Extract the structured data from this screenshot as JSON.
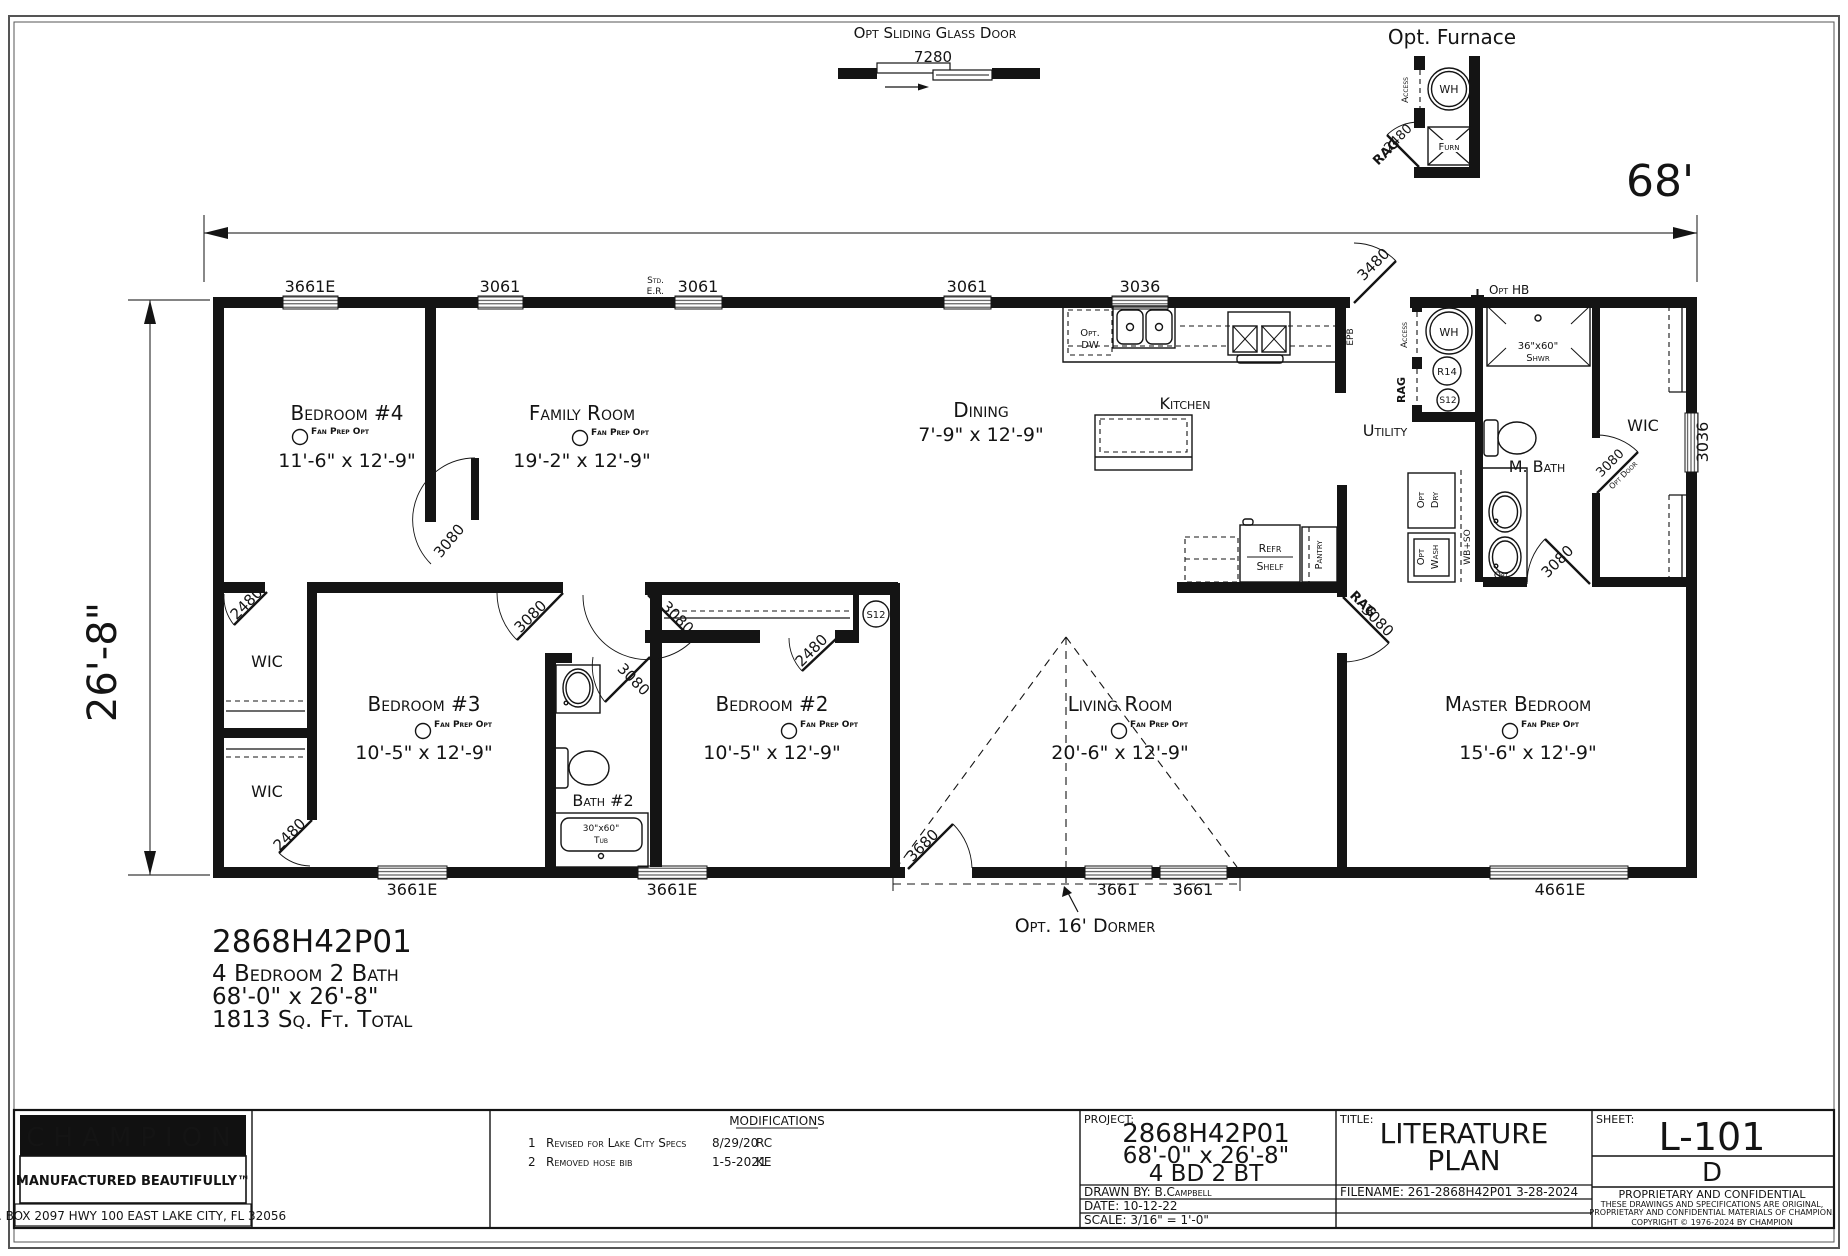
{
  "header": {
    "sliding_door_label": "Opt Sliding Glass Door",
    "sliding_door_dim": "7280",
    "furnace_label": "Opt. Furnace"
  },
  "furnace_detail": {
    "access": "Access",
    "wh": "WH",
    "furn": "Furn",
    "door": "2480",
    "rag": "RAG"
  },
  "dims": {
    "width": "68'",
    "depth": "26'-8\""
  },
  "top_windows": [
    "3661E",
    "3061",
    "3061",
    "3061",
    "3036"
  ],
  "bottom_windows": [
    "3661E",
    "3661E",
    "3661",
    "3661",
    "4661E"
  ],
  "right_window": "3036",
  "top_notes": {
    "std": "Std.",
    "er": "E.R.",
    "opt_hb": "Opt HB",
    "entry_door": "3480"
  },
  "bottom_notes": {
    "entry_door": "3680",
    "dormer": "Opt. 16' Dormer"
  },
  "fan_note": "Fan Prep Opt",
  "rooms": {
    "bedroom4": {
      "name": "Bedroom #4",
      "dims": "11'-6\" x 12'-9\""
    },
    "family": {
      "name": "Family Room",
      "dims": "19'-2\" x 12'-9\""
    },
    "dining": {
      "name": "Dining",
      "dims": "7'-9\" x 12'-9\""
    },
    "kitchen": {
      "name": "Kitchen"
    },
    "utility": {
      "name": "Utility"
    },
    "mbath": {
      "name": "M. Bath"
    },
    "master": {
      "name": "Master Bedroom",
      "dims": "15'-6\" x 12'-9\""
    },
    "living": {
      "name": "Living Room",
      "dims": "20'-6\" x 12'-9\""
    },
    "bedroom3": {
      "name": "Bedroom #3",
      "dims": "10'-5\" x 12'-9\""
    },
    "bedroom2": {
      "name": "Bedroom #2",
      "dims": "10'-5\" x 12'-9\""
    },
    "bath2": {
      "name": "Bath #2"
    },
    "wic_upper": "WIC",
    "wic_lower": "WIC",
    "wic_master": "WIC"
  },
  "doors": {
    "bedroom4": "3080",
    "bedroom3": "3080",
    "bedroom2": "3080",
    "bath2": "3080",
    "wic_upper": "2480",
    "wic_lower": "2480",
    "closet2": "2480",
    "master_rag": "RAG",
    "master_rag_dim": "3080",
    "mbath": "3080",
    "mwic": "3080",
    "mwic_note": "Opt Door"
  },
  "kitchen_detail": {
    "opt_dw1": "Opt.",
    "opt_dw2": "DW",
    "epb": "EPB"
  },
  "utility_detail": {
    "access": "Access",
    "rag": "RAG",
    "wh": "WH",
    "r14": "R14",
    "s12": "S12",
    "opt_dry1": "Opt",
    "opt_dry2": "Dry",
    "opt_wash1": "Opt",
    "opt_wash2": "Wash",
    "wb_so": "WB+SO"
  },
  "closet2_s12": "S12",
  "mbath_detail": {
    "shower_size": "36\"x60\"",
    "shower": "Shwr",
    "sink_opt": "Opt"
  },
  "bath2_detail": {
    "tub_size": "30\"x60\"",
    "tub": "Tub"
  },
  "storage": {
    "refr": "Refr",
    "shelf": "Shelf",
    "pantry": "Pantry"
  },
  "model_info": {
    "model": "2868H42P01",
    "config": "4 Bedroom 2 Bath",
    "size": "68'-0\" x 26'-8\"",
    "area": "1813 Sq. Ft. Total"
  },
  "title_block": {
    "brand": "CHAMPION",
    "tagline": "MANUFACTURED BEAUTIFULLY™",
    "address": "P.O. BOX 2097 HWY 100 EAST LAKE CITY, FL  32056",
    "modifications_title": "MODIFICATIONS",
    "modifications": [
      {
        "num": "1",
        "desc": "Revised for Lake City Specs",
        "date": "8/29/20",
        "by": "RC"
      },
      {
        "num": "2",
        "desc": "Removed hose bib",
        "date": "1-5-2021",
        "by": "KE"
      }
    ],
    "project_label": "PROJECT:",
    "project_model": "2868H42P01",
    "project_size": "68'-0\" x 26'-8\"",
    "project_config": "4 BD 2 BT",
    "drawn_by": "DRAWN BY: B.Campbell",
    "date": "DATE: 10-12-22",
    "scale": "SCALE: 3/16\" = 1'-0\"",
    "title_label": "TITLE:",
    "title_line1": "LITERATURE",
    "title_line2": "PLAN",
    "filename": "FILENAME: 261-2868H42P01 3-28-2024",
    "sheet_label": "SHEET:",
    "sheet_number": "L-101",
    "revision": "D",
    "conf1": "PROPRIETARY AND CONFIDENTIAL",
    "conf2": "THESE DRAWINGS AND SPECIFICATIONS ARE ORIGINAL,",
    "conf3": "PROPRIETARY AND CONFIDENTIAL MATERIALS OF CHAMPION.",
    "conf4": "COPYRIGHT © 1976-2024 BY CHAMPION"
  }
}
